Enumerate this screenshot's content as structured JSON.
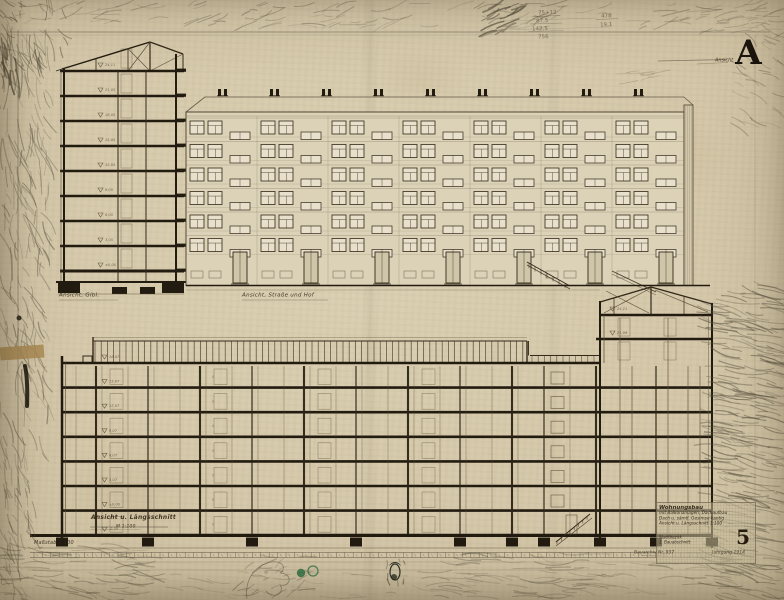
{
  "marks": {
    "revision_prefix": "Ansicht",
    "revision_letter": "A",
    "sheet_number": "5"
  },
  "captions": {
    "gable": "Ansicht, Gibl.",
    "facade": "Ansicht, Straße und Hof",
    "long_section": "Ansicht u. Längsschnitt",
    "long_scale": "M 1:100",
    "scale_note": "Maßstab 1:100"
  },
  "drawings": {
    "gable_section": {
      "floors": 9,
      "levels": [
        "24,11",
        "21,05",
        "18,05",
        "15,05",
        "12,05",
        "9,05",
        "6,05",
        "3,05",
        "±0,00"
      ]
    },
    "street_elevation": {
      "storeys": 7,
      "window_rows": 6,
      "window_bays": 7
    },
    "long_section": {
      "floors": 8,
      "levels": [
        "18,07",
        "15,07",
        "12,07",
        "9,07",
        "6,07",
        "3,07",
        "±0,00",
        "-2,20"
      ],
      "tower_levels": [
        "24,11",
        "21,09"
      ],
      "door_tag": "8"
    }
  },
  "title_block": {
    "heading": "Wohnungsbau",
    "lines": [
      "mit Balkonanlagen, Dachaufbau",
      "Dach u. sämtl. Gesimse kantig",
      "Ansicht u. Längsschnitt 1:100"
    ],
    "row_left": "Stadtbezirk",
    "row_left2": "1. Bauabschnitt",
    "number": "5",
    "footer_left": "Bauarchiv Nr. 937",
    "footer_mid": "Jahrgang 1914"
  },
  "pencil": {
    "stack": [
      "75+12",
      "87,5",
      "142,5",
      "756"
    ],
    "side": [
      "478",
      "19,1"
    ]
  },
  "colors": {
    "paper": "#d6c9ab",
    "ink": "#33291a",
    "heavy": "#221b10",
    "pencil_gray": "#56503f",
    "green_mark": "#37764a",
    "tape": "#a98a52"
  }
}
